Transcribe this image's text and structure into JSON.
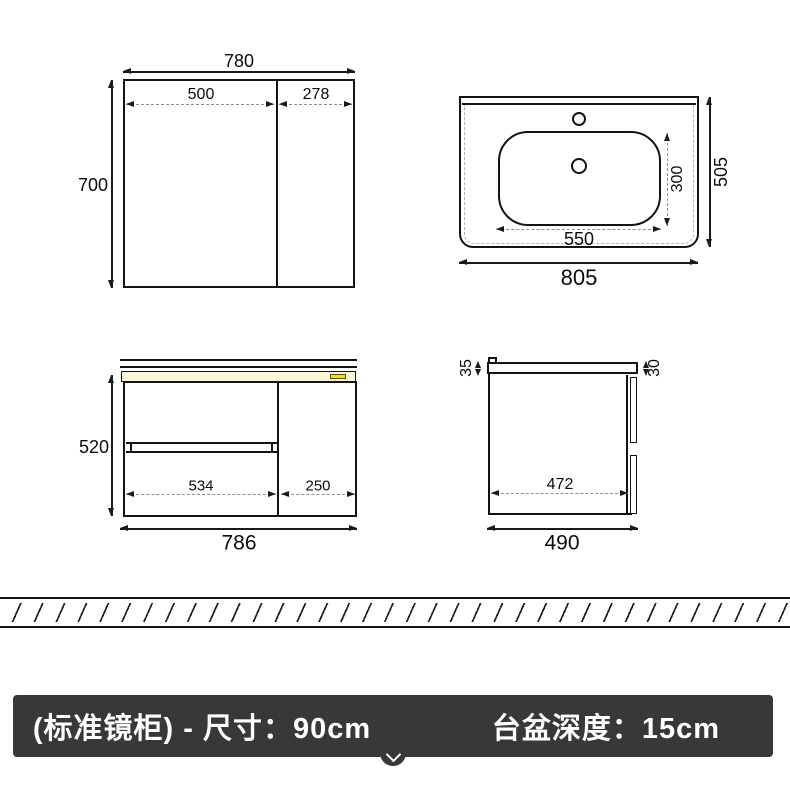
{
  "drawings": {
    "mirror_cabinet": {
      "overall_width": "780",
      "overall_height": "700",
      "left_door_width": "500",
      "right_door_width": "278"
    },
    "basin_top_view": {
      "overall_width": "805",
      "overall_depth": "505",
      "bowl_width": "550",
      "bowl_depth": "300"
    },
    "cabinet_front_view": {
      "overall_width": "786",
      "overall_height": "520",
      "drawers_width": "534",
      "door_width": "250"
    },
    "cabinet_side_view": {
      "overall_depth": "490",
      "inner_depth": "472",
      "countertop_thickness": "35",
      "door_thickness": "30"
    }
  },
  "footer": {
    "left_label": "(标准镜柜) - 尺寸：90cm",
    "right_label": "台盆深度：15cm",
    "chevron_icon": "chevron-down"
  },
  "colors": {
    "line": "#1a1a1a",
    "dashed_line": "#8f8f8f",
    "cream_strip": "#fbf6d8",
    "yellow_chip": "#f0e10b",
    "footer_background": "#383838",
    "footer_text": "#ffffff"
  }
}
